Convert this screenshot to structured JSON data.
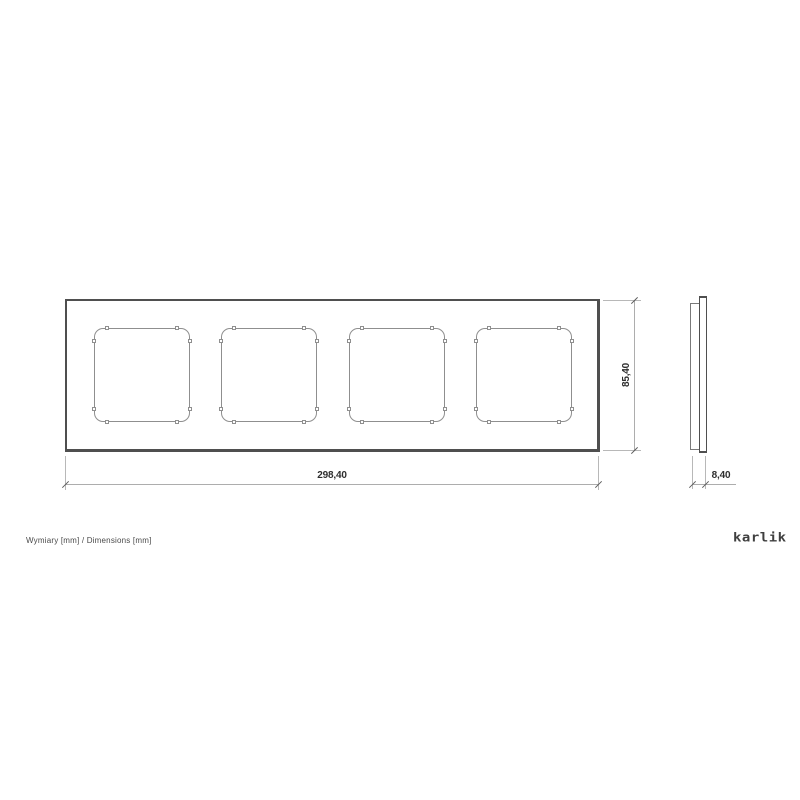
{
  "drawing": {
    "caption": "Wymiary [mm] / Dimensions [mm]",
    "brand": "karlik",
    "views": {
      "front": {
        "width_mm": "298,40",
        "height_mm": "85,40",
        "openings": 4
      },
      "side": {
        "depth_mm": "8,40"
      }
    }
  }
}
